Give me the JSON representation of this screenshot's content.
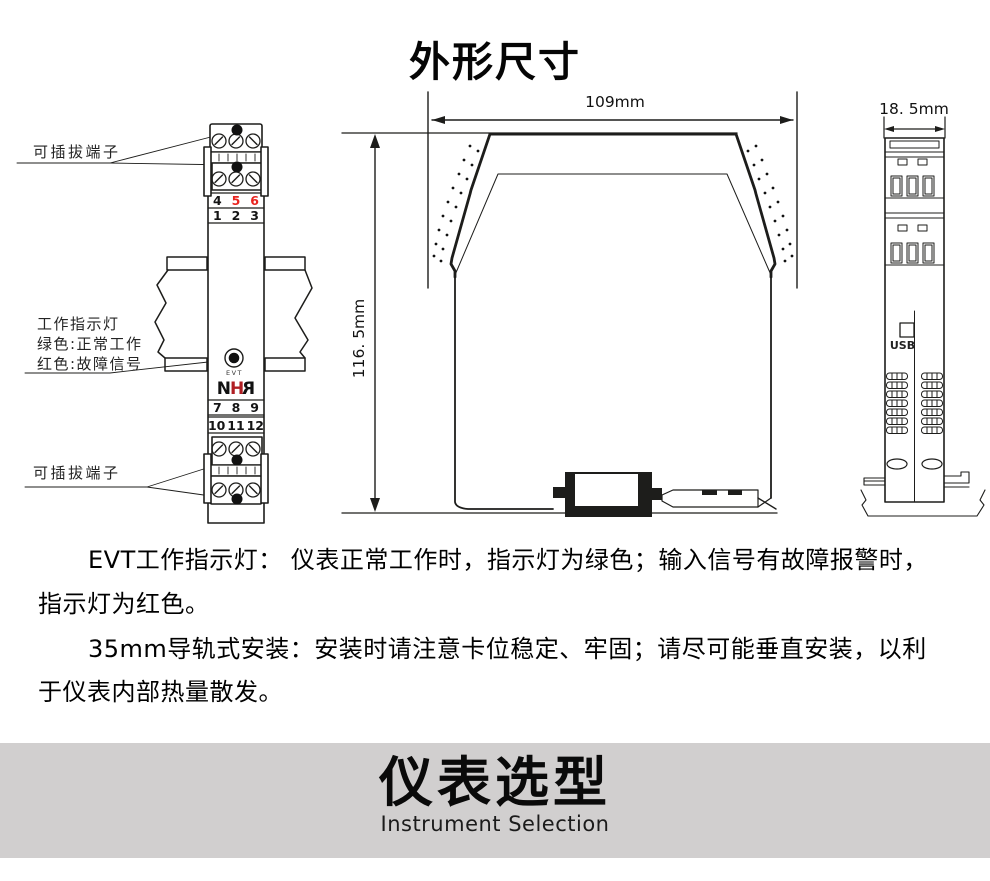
{
  "title": "外形尺寸",
  "front_view": {
    "pluggable_label_top": "可插拔端子",
    "pluggable_label_bottom": "可插拔端子",
    "indicator_labels": [
      "工作指示灯",
      "绿色:正常工作",
      "红色:故障信号"
    ],
    "indicator_tag": "EVT",
    "logo_letters": [
      "N",
      "H",
      "R"
    ],
    "terminals_top_row1": [
      "4",
      "5",
      "6"
    ],
    "terminals_top_row2": [
      "1",
      "2",
      "3"
    ],
    "terminals_bottom_row1": [
      "7",
      "8",
      "9"
    ],
    "terminals_bottom_row2": [
      "10",
      "11",
      "12"
    ]
  },
  "dimensions": {
    "width": "109mm",
    "height": "116. 5mm",
    "depth": "18. 5mm"
  },
  "profile_view": {
    "usb_label": "USB"
  },
  "notes": {
    "p1_line1": "EVT工作指示灯： 仪表正常工作时，指示灯为绿色；输入信号有故障报警时，",
    "p1_line2": "指示灯为红色。",
    "p2_line1": "35mm导轨式安装：安装时请注意卡位稳定、牢固；请尽可能垂直安装，以利",
    "p2_line2": "于仪表内部热量散发。"
  },
  "banner": {
    "title": "仪表选型",
    "subtitle": "Instrument Selection"
  },
  "colors": {
    "line": "#1d1d1b",
    "terminal_number_red": "#e8241f",
    "logo_red": "#b01e23",
    "banner_background": "#d1cfcf"
  }
}
